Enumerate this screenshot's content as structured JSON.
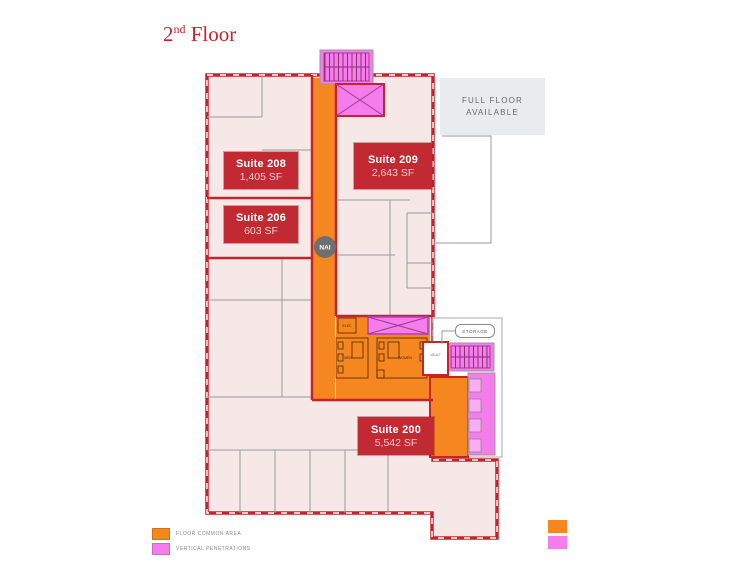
{
  "title": {
    "prefix": "2",
    "ordinal": "nd",
    "suffix": " Floor"
  },
  "plan": {
    "suites": [
      {
        "name": "Suite 208",
        "area": "1,405 SF"
      },
      {
        "name": "Suite 206",
        "area": "603 SF"
      },
      {
        "name": "Suite 209",
        "area": "2,643 SF"
      },
      {
        "name": "Suite 200",
        "area": "5,542 SF"
      }
    ],
    "callout": {
      "line1": "FULL FLOOR",
      "line2": "AVAILABLE"
    },
    "labels": {
      "storage": "STORAGE",
      "vault": "VAULT",
      "men": "MEN",
      "women": "WOMEN",
      "elec": "ELEC"
    },
    "badge": "NAI"
  },
  "legend": {
    "items": [
      {
        "label": "FLOOR COMMON AREA",
        "color": "#F6861F"
      },
      {
        "label": "VERTICAL PENETRATIONS",
        "color": "#F47CEB"
      }
    ]
  },
  "colors": {
    "outline_red": "#C5242B",
    "suite_fill": "#F7E8E8",
    "common_orange": "#F6861F",
    "penetration_pink": "#F47CEB",
    "label_box": "#C22A33",
    "callout_bg": "#E9ECEF"
  }
}
